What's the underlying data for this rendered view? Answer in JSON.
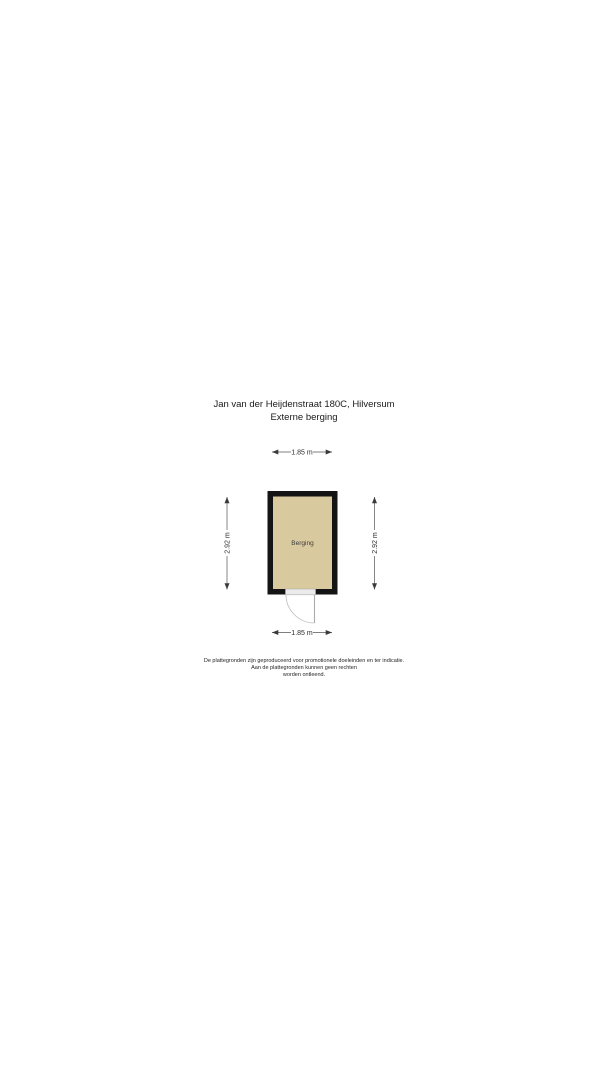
{
  "header": {
    "title": "Jan van der Heijdenstraat 180C, Hilversum",
    "subtitle": "Externe berging"
  },
  "floorplan": {
    "room_label": "Berging",
    "floor_fill_color": "#d9c99e",
    "wall_color": "#141414",
    "dimensions": {
      "top": "1.85 m",
      "bottom": "1.85 m",
      "left": "2.92 m",
      "right": "2.92 m"
    }
  },
  "footer": {
    "disclaimer_line1": "De plattegronden zijn geproduceerd voor promotionele doeleinden en ter indicatie.",
    "disclaimer_line2": "Aan de plattegronden kunnen geen rechten",
    "disclaimer_line3": "worden ontleend."
  }
}
